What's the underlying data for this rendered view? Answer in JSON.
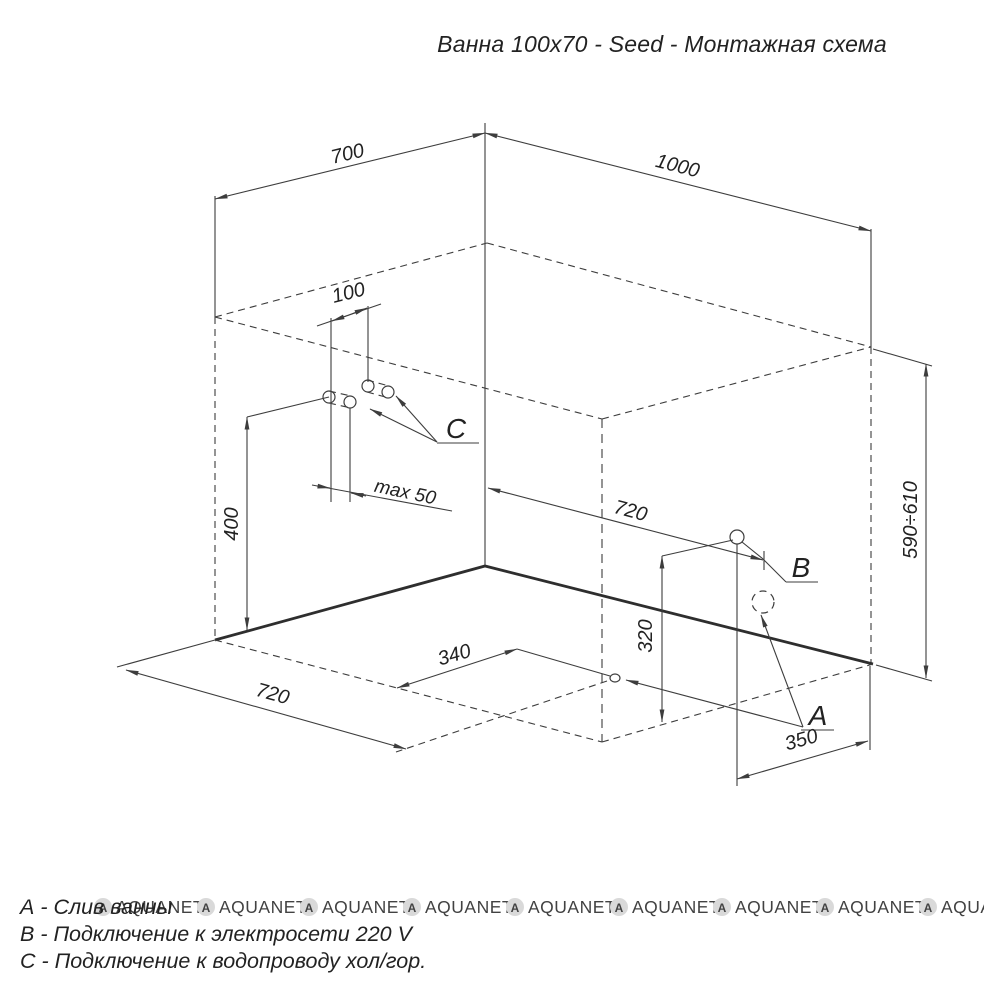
{
  "title": "Ванна 100x70 - Seed - Монтажная схема",
  "dims": {
    "top_width": "700",
    "top_length": "1000",
    "pipes_spacing": "100",
    "pipes_protrusion": "max 50",
    "water_conn_height": "400",
    "electric_along_wall": "720",
    "electric_height": "320",
    "electric_from_right": "350",
    "drain_along_wall": "720",
    "drain_from_front": "340",
    "rim_height": "590÷610"
  },
  "labels": {
    "drain": "A",
    "electric": "B",
    "water": "C"
  },
  "legend": {
    "line_a": "А - Слив ванны",
    "line_b": "В - Подключение к электросети 220 V",
    "line_c": "С - Подключение к водопроводу хол/гор."
  },
  "watermark": {
    "symbol": "A",
    "text": "AQUANET"
  },
  "colors": {
    "line": "#3d3d3d",
    "watermark": "#d3d3d3"
  }
}
